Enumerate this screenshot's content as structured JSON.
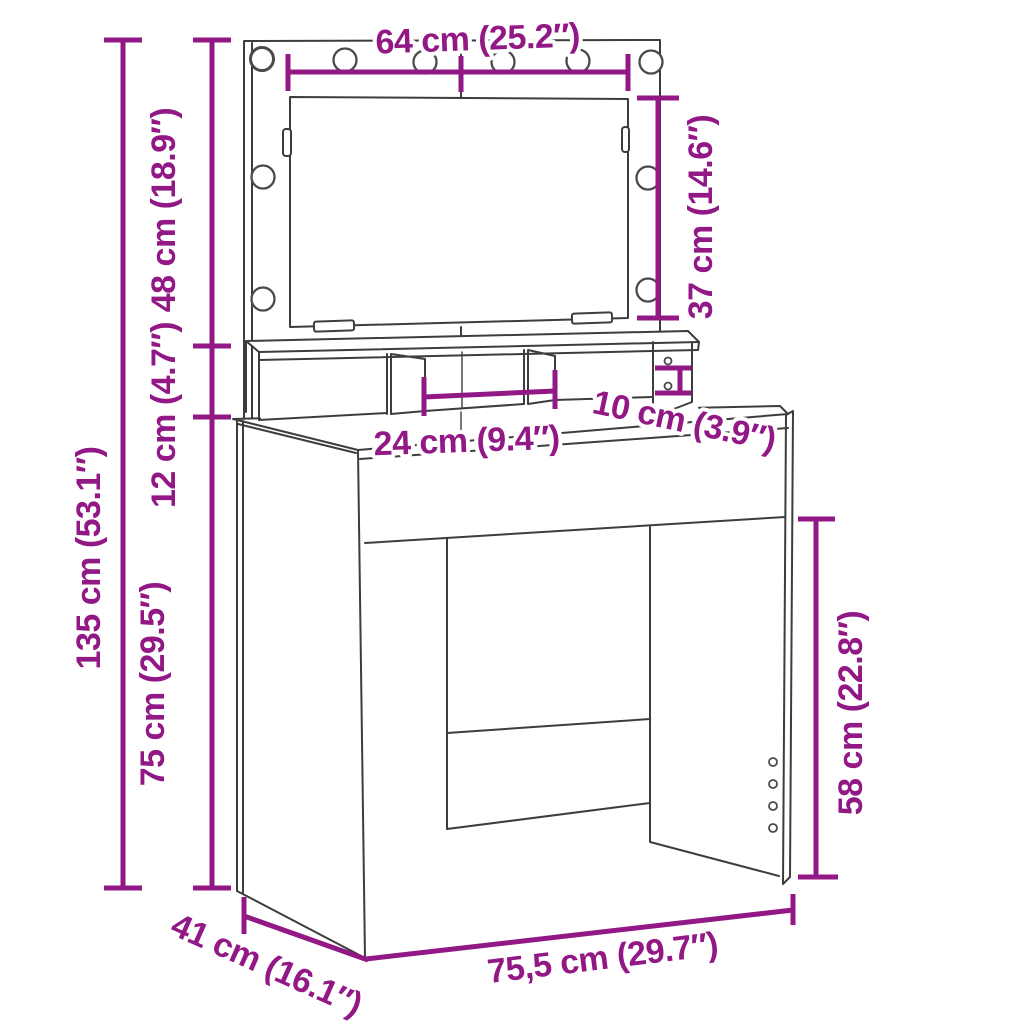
{
  "diagram": {
    "type": "furniture-dimension-drawing",
    "product": "dressing table with illuminated mirror and organizer shelf",
    "colors": {
      "background": "#ffffff",
      "line_art": "#3d3d3d",
      "dimension_annotation": "#921886"
    },
    "features": {
      "light_bulb_count": 10,
      "shelf_cam_hole_count": 2,
      "leg_panel_hole_count": 4
    },
    "dimensions": {
      "mirror_width": "64 cm (25.2″)",
      "mirror_glass_height": "37 cm (14.6″)",
      "mirror_panel_height": "48 cm (18.9″)",
      "organizer_height": "12 cm (4.7″)",
      "total_height": "135 cm (53.1″)",
      "table_height": "75 cm (29.5″)",
      "compartment_width": "24 cm (9.4″)",
      "niche_height": "10 cm (3.9″)",
      "legroom_height": "58 cm (22.8″)",
      "depth": "41 cm (16.1″)",
      "total_width": "75,5 cm (29.7″)"
    }
  }
}
